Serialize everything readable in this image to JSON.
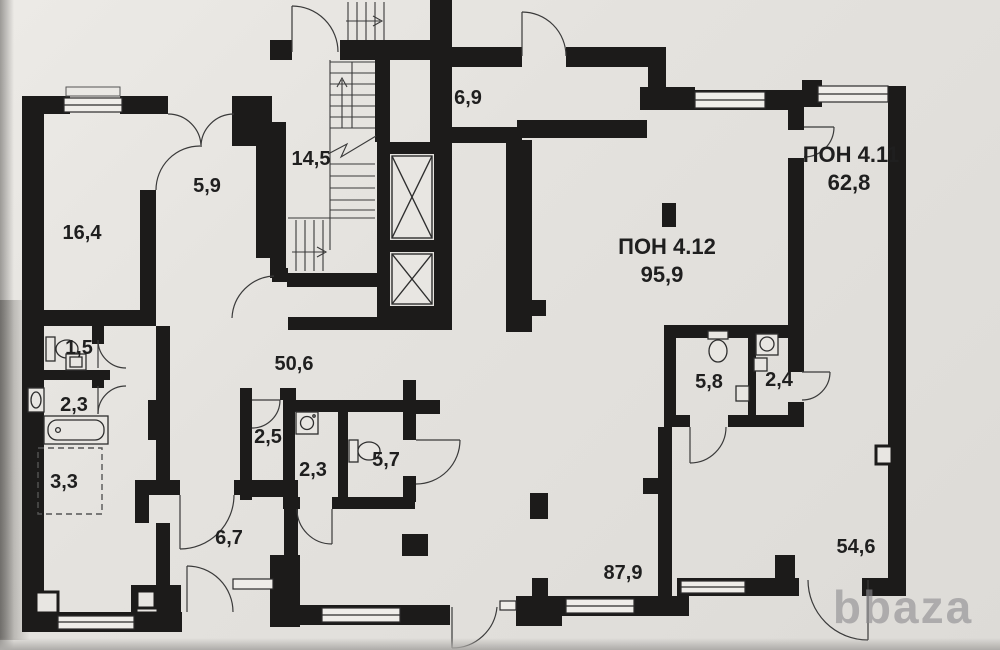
{
  "document": {
    "type": "floor-plan-photo",
    "watermark": "bbaza"
  },
  "units": {
    "pon411": {
      "name": "ПОН 4.11",
      "area": "62,8"
    },
    "pon412": {
      "name": "ПОН 4.12",
      "area": "95,9"
    }
  },
  "rooms": {
    "r16_4": "16,4",
    "r5_9": "5,9",
    "r14_5": "14,5",
    "r6_9": "6,9",
    "r1_5": "1,5",
    "r2_3a": "2,3",
    "r3_3": "3,3",
    "r50_6": "50,6",
    "r2_5": "2,5",
    "r2_3b": "2,3",
    "r5_7": "5,7",
    "r6_7": "6,7",
    "r87_9": "87,9",
    "r5_8": "5,8",
    "r2_4": "2,4",
    "r54_6": "54,6"
  },
  "colors": {
    "wall": "#1c1b1a",
    "paper": "#e4e2de",
    "line": "#3a3a3a",
    "watermark": "#8d8c8f"
  }
}
